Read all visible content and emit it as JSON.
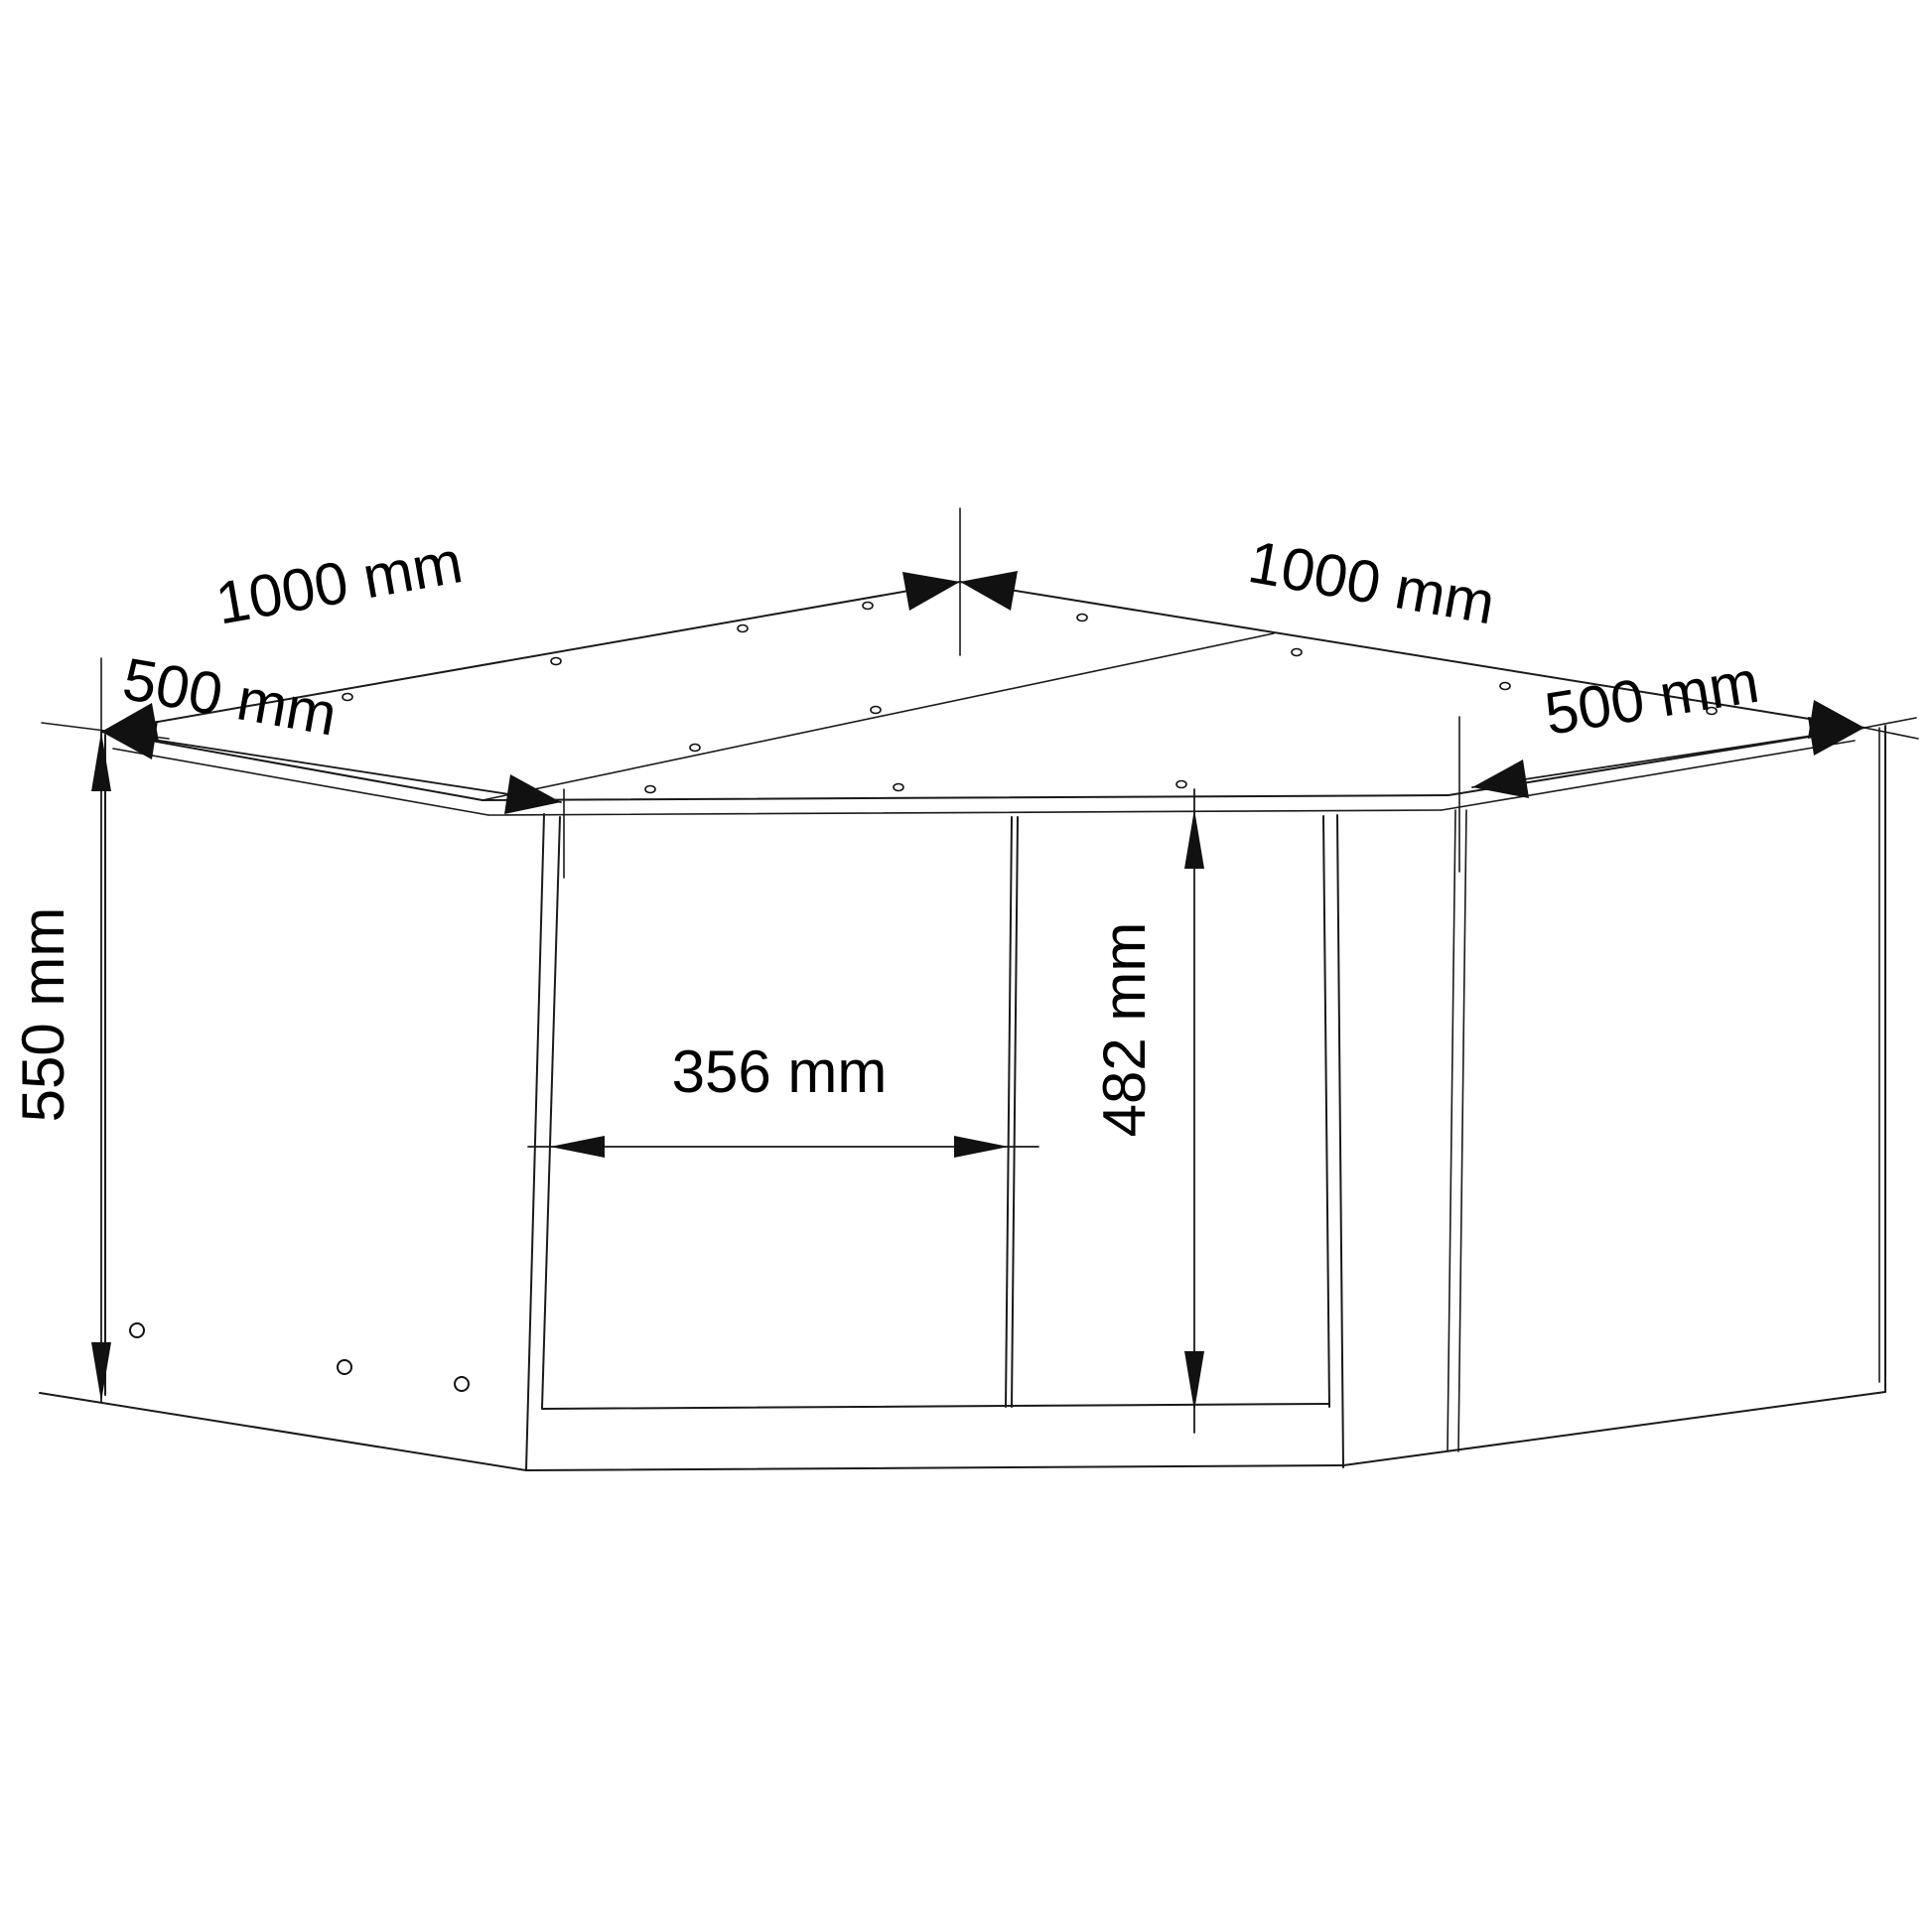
{
  "drawing": {
    "title": "corner-cabinet-dimension-diagram",
    "background_color": "#ffffff",
    "line_color": "#1a1a1a",
    "arrow_color": "#111111",
    "unit": "mm",
    "dimensions": {
      "back_left_width": {
        "value": 1000,
        "unit": "mm",
        "text": "1000 mm"
      },
      "back_right_width": {
        "value": 1000,
        "unit": "mm",
        "text": "1000 mm"
      },
      "left_side_depth": {
        "value": 500,
        "unit": "mm",
        "text": "500 mm"
      },
      "right_side_depth": {
        "value": 500,
        "unit": "mm",
        "text": "500 mm"
      },
      "cabinet_height": {
        "value": 550,
        "unit": "mm",
        "text": "550 mm"
      },
      "door_width": {
        "value": 356,
        "unit": "mm",
        "text": "356 mm"
      },
      "door_height": {
        "value": 482,
        "unit": "mm",
        "text": "482 mm"
      }
    }
  }
}
